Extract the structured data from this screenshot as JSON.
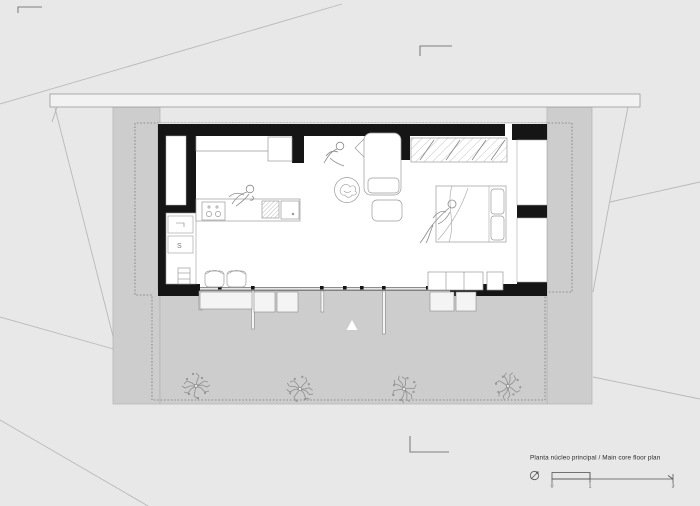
{
  "title_block": {
    "label": "Planta núcleo principal / Main core floor plan",
    "scale_ticks": [
      "0",
      "1",
      "3"
    ]
  },
  "fixtures": {
    "laundry_trap_glyph": "S"
  },
  "markers": {
    "entry_marker": "triangle-up"
  },
  "colors": {
    "background": "#e8e8e8",
    "site_gray": "#cdcdcd",
    "wall_black": "#151515",
    "sketch_line": "#999999",
    "terrain_line": "#b8b8b8",
    "dashed_outline": "#787878"
  }
}
